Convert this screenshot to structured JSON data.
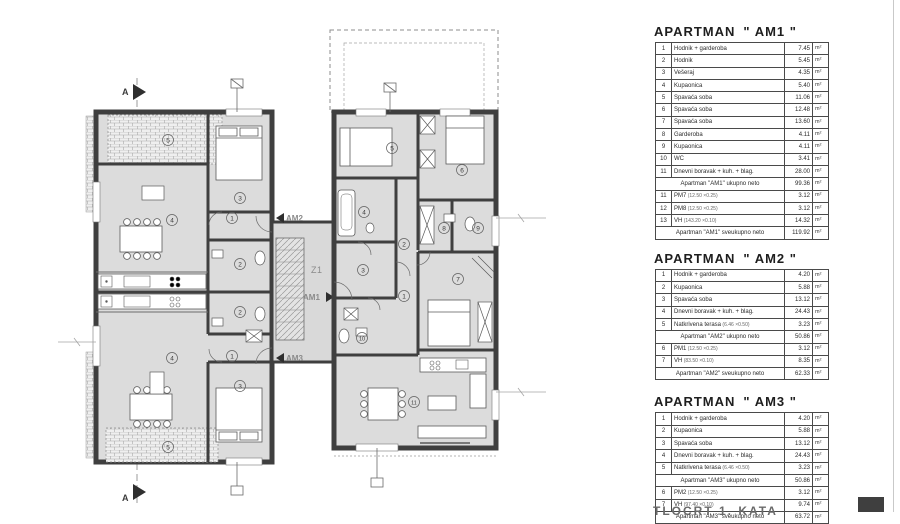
{
  "colors": {
    "wall": "#3f3f3f",
    "room_fill": "#dcdcdc",
    "hatch_line": "#9a9a9a",
    "table_border": "#3a3a3a"
  },
  "plan": {
    "section_label": "A",
    "stair_label": "Z1",
    "unit_arrows": {
      "am1": "AM1",
      "am2": "AM2",
      "am3": "AM3"
    },
    "am2_numbers": [
      "1",
      "2",
      "3",
      "4",
      "5"
    ],
    "am3_numbers": [
      "1",
      "2",
      "3",
      "4",
      "5"
    ],
    "am1_numbers": [
      "1",
      "2",
      "3",
      "4",
      "5",
      "6",
      "7",
      "8",
      "9",
      "10",
      "11"
    ]
  },
  "tables": [
    {
      "title_prefix": "APARTMAN",
      "title_name": "\" AM1 \"",
      "unit": "m²",
      "rows": [
        {
          "n": "1",
          "label": "Hodnik + garderoba",
          "v": "7.45"
        },
        {
          "n": "2",
          "label": "Hodnik",
          "v": "5.45"
        },
        {
          "n": "3",
          "label": "Vešeraj",
          "v": "4.35"
        },
        {
          "n": "4",
          "label": "Kupaonica",
          "v": "5.40"
        },
        {
          "n": "5",
          "label": "Spavaća soba",
          "v": "11.06"
        },
        {
          "n": "6",
          "label": "Spavaća soba",
          "v": "12.48"
        },
        {
          "n": "7",
          "label": "Spavaća soba",
          "v": "13.60"
        },
        {
          "n": "8",
          "label": "Garderoba",
          "v": "4.11"
        },
        {
          "n": "9",
          "label": "Kupaonica",
          "v": "4.11"
        },
        {
          "n": "10",
          "label": "WC",
          "v": "3.41"
        },
        {
          "n": "11",
          "label": "Dnevni boravak + kuh. + blag.",
          "v": "28.00"
        },
        {
          "summary": true,
          "label": "Apartman \"AM1\" ukupno neto",
          "v": "99.36"
        },
        {
          "n": "11",
          "label": "PM7",
          "sub": "(12.50 ×0.25)",
          "v": "3.12"
        },
        {
          "n": "12",
          "label": "PM8",
          "sub": "(12.50 ×0.25)",
          "v": "3.12"
        },
        {
          "n": "13",
          "label": "VH",
          "sub": "(143.20 ×0.10)",
          "v": "14.32"
        },
        {
          "summary": true,
          "label": "Apartman \"AM1\" sveukupno neto",
          "v": "119.92"
        }
      ]
    },
    {
      "title_prefix": "APARTMAN",
      "title_name": "\" AM2 \"",
      "unit": "m²",
      "rows": [
        {
          "n": "1",
          "label": "Hodnik + garderoba",
          "v": "4.20"
        },
        {
          "n": "2",
          "label": "Kupaonica",
          "v": "5.88"
        },
        {
          "n": "3",
          "label": "Spavaća soba",
          "v": "13.12"
        },
        {
          "n": "4",
          "label": "Dnevni boravak + kuh. + blag.",
          "v": "24.43"
        },
        {
          "n": "5",
          "label": "Natkrivena terasa",
          "sub": "(6.46 ×0.50)",
          "v": "3.23"
        },
        {
          "summary": true,
          "label": "Apartman \"AM2\" ukupno neto",
          "v": "50.86"
        },
        {
          "n": "6",
          "label": "PM1",
          "sub": "(12.50 ×0.25)",
          "v": "3.12"
        },
        {
          "n": "7",
          "label": "VH",
          "sub": "(83.50 ×0.10)",
          "v": "8.35"
        },
        {
          "summary": true,
          "label": "Apartman \"AM2\" sveukupno neto",
          "v": "62.33"
        }
      ]
    },
    {
      "title_prefix": "APARTMAN",
      "title_name": "\" AM3 \"",
      "unit": "m²",
      "rows": [
        {
          "n": "1",
          "label": "Hodnik + garderoba",
          "v": "4.20"
        },
        {
          "n": "2",
          "label": "Kupaonica",
          "v": "5.88"
        },
        {
          "n": "3",
          "label": "Spavaća soba",
          "v": "13.12"
        },
        {
          "n": "4",
          "label": "Dnevni boravak + kuh. + blag.",
          "v": "24.43"
        },
        {
          "n": "5",
          "label": "Natkrivena terasa",
          "sub": "(6.46 ×0.50)",
          "v": "3.23"
        },
        {
          "summary": true,
          "label": "Apartman \"AM3\" ukupno neto",
          "v": "50.86"
        },
        {
          "n": "6",
          "label": "PM2",
          "sub": "(12.50 ×0.25)",
          "v": "3.12"
        },
        {
          "n": "7",
          "label": "VH",
          "sub": "(97.40 ×0.10)",
          "v": "9.74"
        },
        {
          "summary": true,
          "label": "Apartman \"AM3\" sveukupno neto",
          "v": "63.72"
        }
      ]
    }
  ],
  "footer": {
    "caption": "TLOCRT 1. KATA"
  }
}
